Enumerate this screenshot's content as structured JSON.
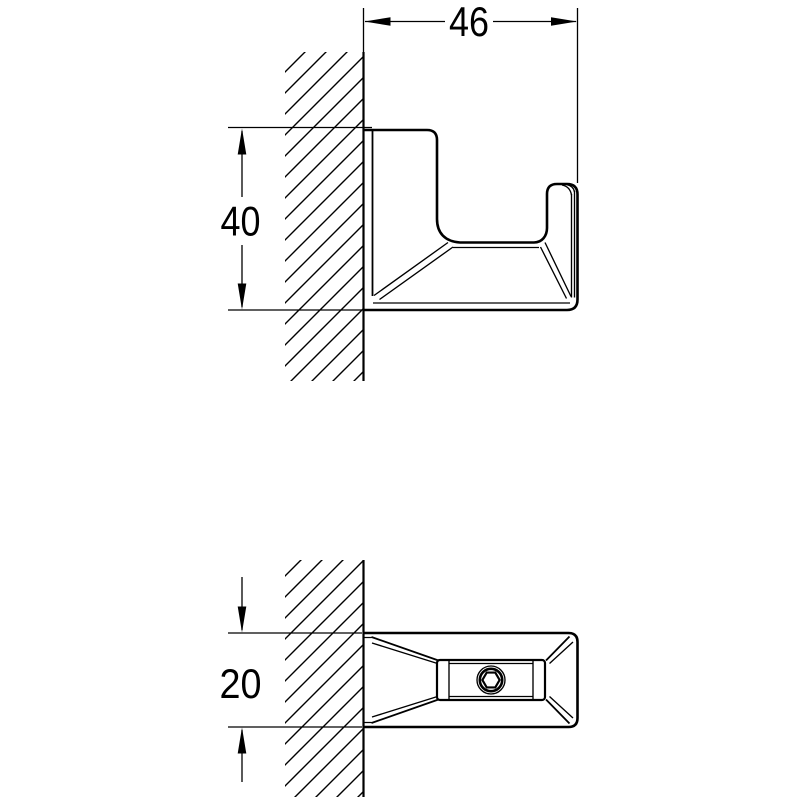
{
  "colors": {
    "line": "#000000",
    "background": "#ffffff"
  },
  "dimensions": {
    "width": {
      "value": "46",
      "orientation": "horizontal",
      "view": "side"
    },
    "height": {
      "value": "40",
      "orientation": "vertical",
      "view": "side"
    },
    "depth": {
      "value": "20",
      "orientation": "vertical",
      "view": "top"
    }
  },
  "icons": {
    "screw": "hex-socket-screw-icon"
  }
}
